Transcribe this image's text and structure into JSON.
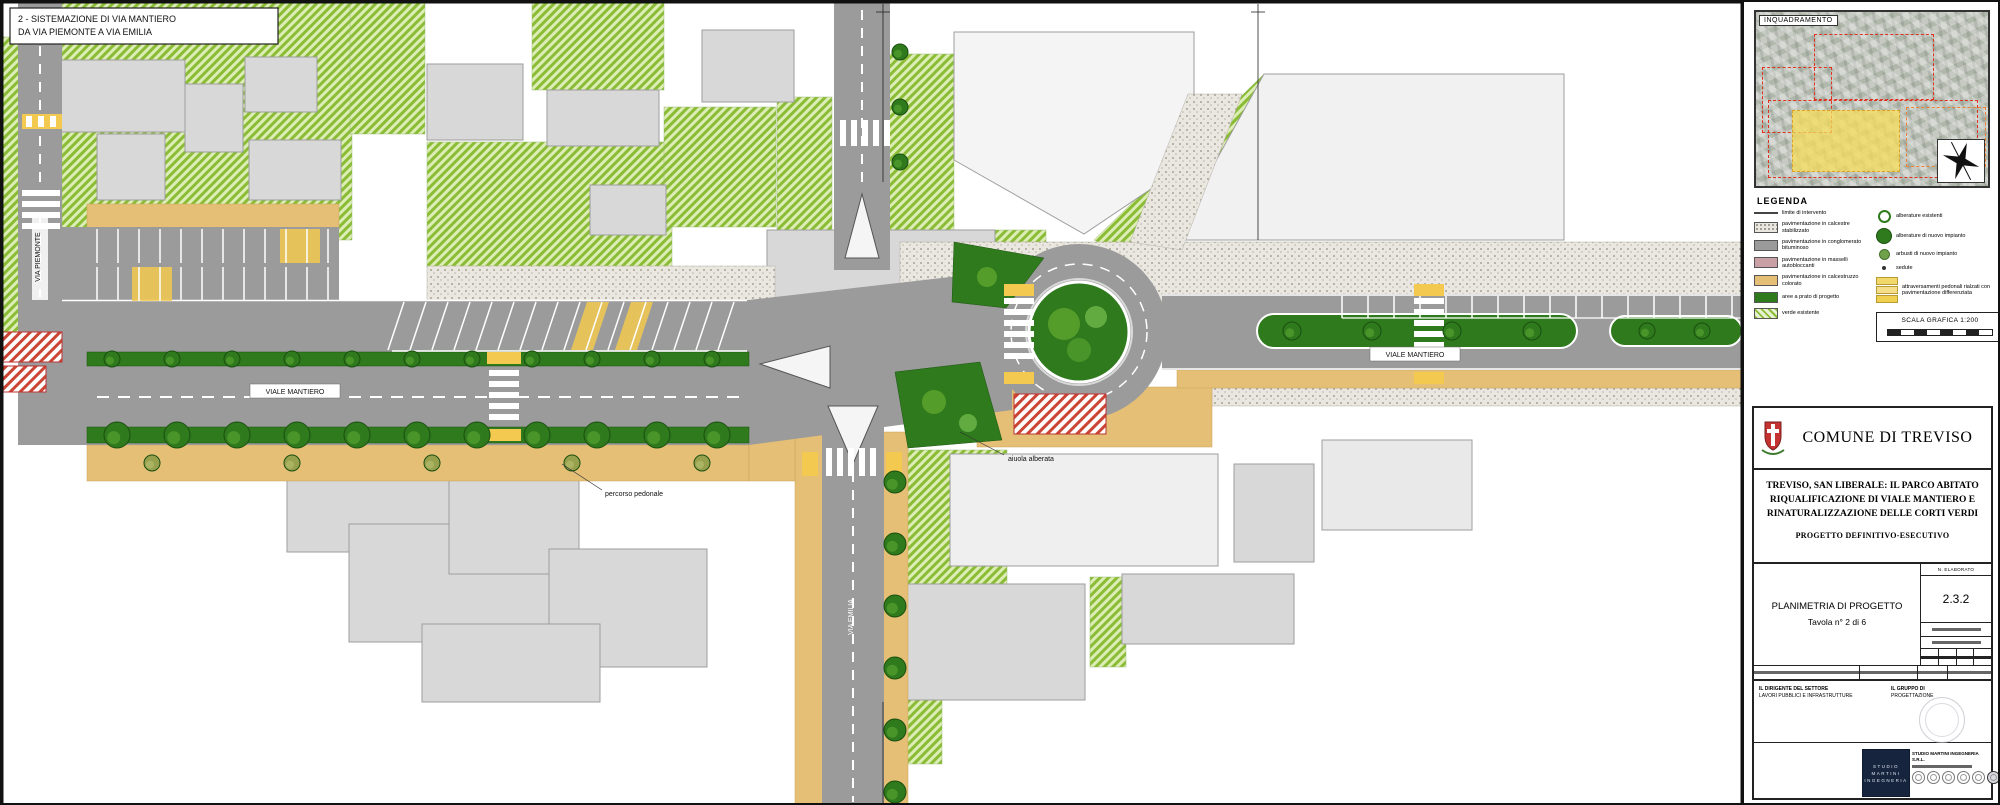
{
  "sheet": {
    "note_line1": "2 - SISTEMAZIONE DI VIA MANTIERO",
    "note_line2": "DA VIA PIEMONTE A VIA EMILIA"
  },
  "map": {
    "labels": {
      "road_west": "VIALE MANTIERO",
      "road_east": "VIALE MANTIERO",
      "street_left": "VIA PIEMONTE",
      "street_south": "VIA EMILIA",
      "annotation1": "percorso pedonale",
      "annotation2": "aiuola alberata"
    }
  },
  "panel": {
    "inset": {
      "title": "INQUADRAMENTO"
    },
    "legend": {
      "title": "LEGENDA",
      "left_items": [
        "limite di intervento",
        "pavimentazione in calcestre stabilizzato",
        "pavimentazione in conglomerato bituminoso",
        "pavimentazione in masselli autobloccanti",
        "pavimentazione in calcestruzzo colorato",
        "aree a prato di progetto",
        "verde esistente"
      ],
      "right_items": [
        "alberature esistenti",
        "alberature di nuovo impianto",
        "arbusti di nuovo impianto",
        "sedute"
      ],
      "raised_crossing_label": "attraversamenti pedonali rialzati con pavimentazione differenziata",
      "scale_label": "SCALA GRAFICA 1:200"
    },
    "title_block": {
      "municipality": "COMUNE DI TREVISO",
      "project_line1": "TREVISO, SAN LIBERALE: IL PARCO ABITATO",
      "project_line2": "RIQUALIFICAZIONE DI VIALE MANTIERO E",
      "project_line3": "RINATURALIZZAZIONE DELLE CORTI VERDI",
      "phase": "PROGETTO DEFINITIVO-ESECUTIVO",
      "drawing_title": "PLANIMETRIA DI PROGETTO",
      "sheet_label": "Tavola n° 2 di 6",
      "elaborato_header": "N. ELABORATO",
      "elaborato_code": "2.3.2",
      "sig_left_line1": "IL DIRIGENTE DEL SETTORE",
      "sig_left_line2": "LAVORI PUBBLICI E INFRASTRUTTURE",
      "sig_right_line1": "IL GRUPPO DI",
      "sig_right_line2": "PROGETTAZIONE",
      "logo_line1": "STUDIO",
      "logo_line2": "MARTINI",
      "logo_line3": "INGEGNERIA",
      "firm_name": "STUDIO MARTINI INGEGNERIA S.R.L."
    },
    "colors": {
      "accent_red": "#e03020",
      "highlight_yellow": "#f2d86a",
      "road_gray": "#9b9b9b",
      "grass_green": "#2e7a1c",
      "sand": "#e5bf76"
    }
  }
}
